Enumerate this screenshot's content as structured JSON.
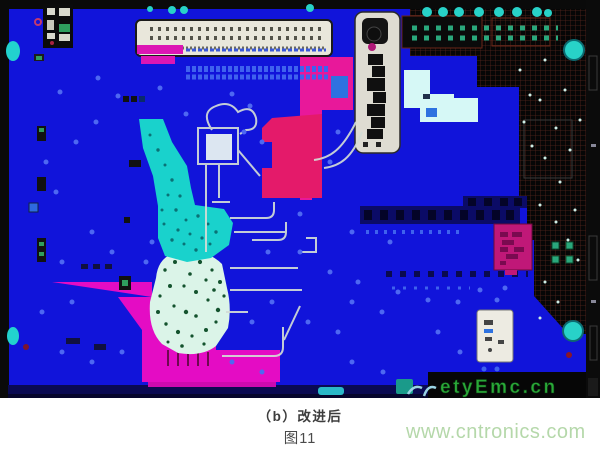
{
  "figure": {
    "caption": "（b）改进后",
    "figure_number": "图11",
    "site_watermark": "www.cntronics.com",
    "board_watermark": "etyEmc.cn"
  },
  "image": {
    "colors": {
      "board_blue": "#1114da",
      "plane_black": "#060606",
      "hatch_line": "#55241c",
      "copper_magenta": "#e40cc4",
      "copper_pink": "#e8189a",
      "copper_crimson": "#e41a6a",
      "copper_cyan": "#19d2cc",
      "copper_mint": "#dbf4e8",
      "pale_cyan": "#d6f8f6",
      "silkscreen_white": "#dedcd2",
      "via_blue": "#4e68f2",
      "pad_teal": "#2aa87c",
      "ring_cyan": "#28d2c8",
      "board_watermark_green": "#2aa838",
      "site_watermark_green": "#b5d8aa"
    }
  }
}
